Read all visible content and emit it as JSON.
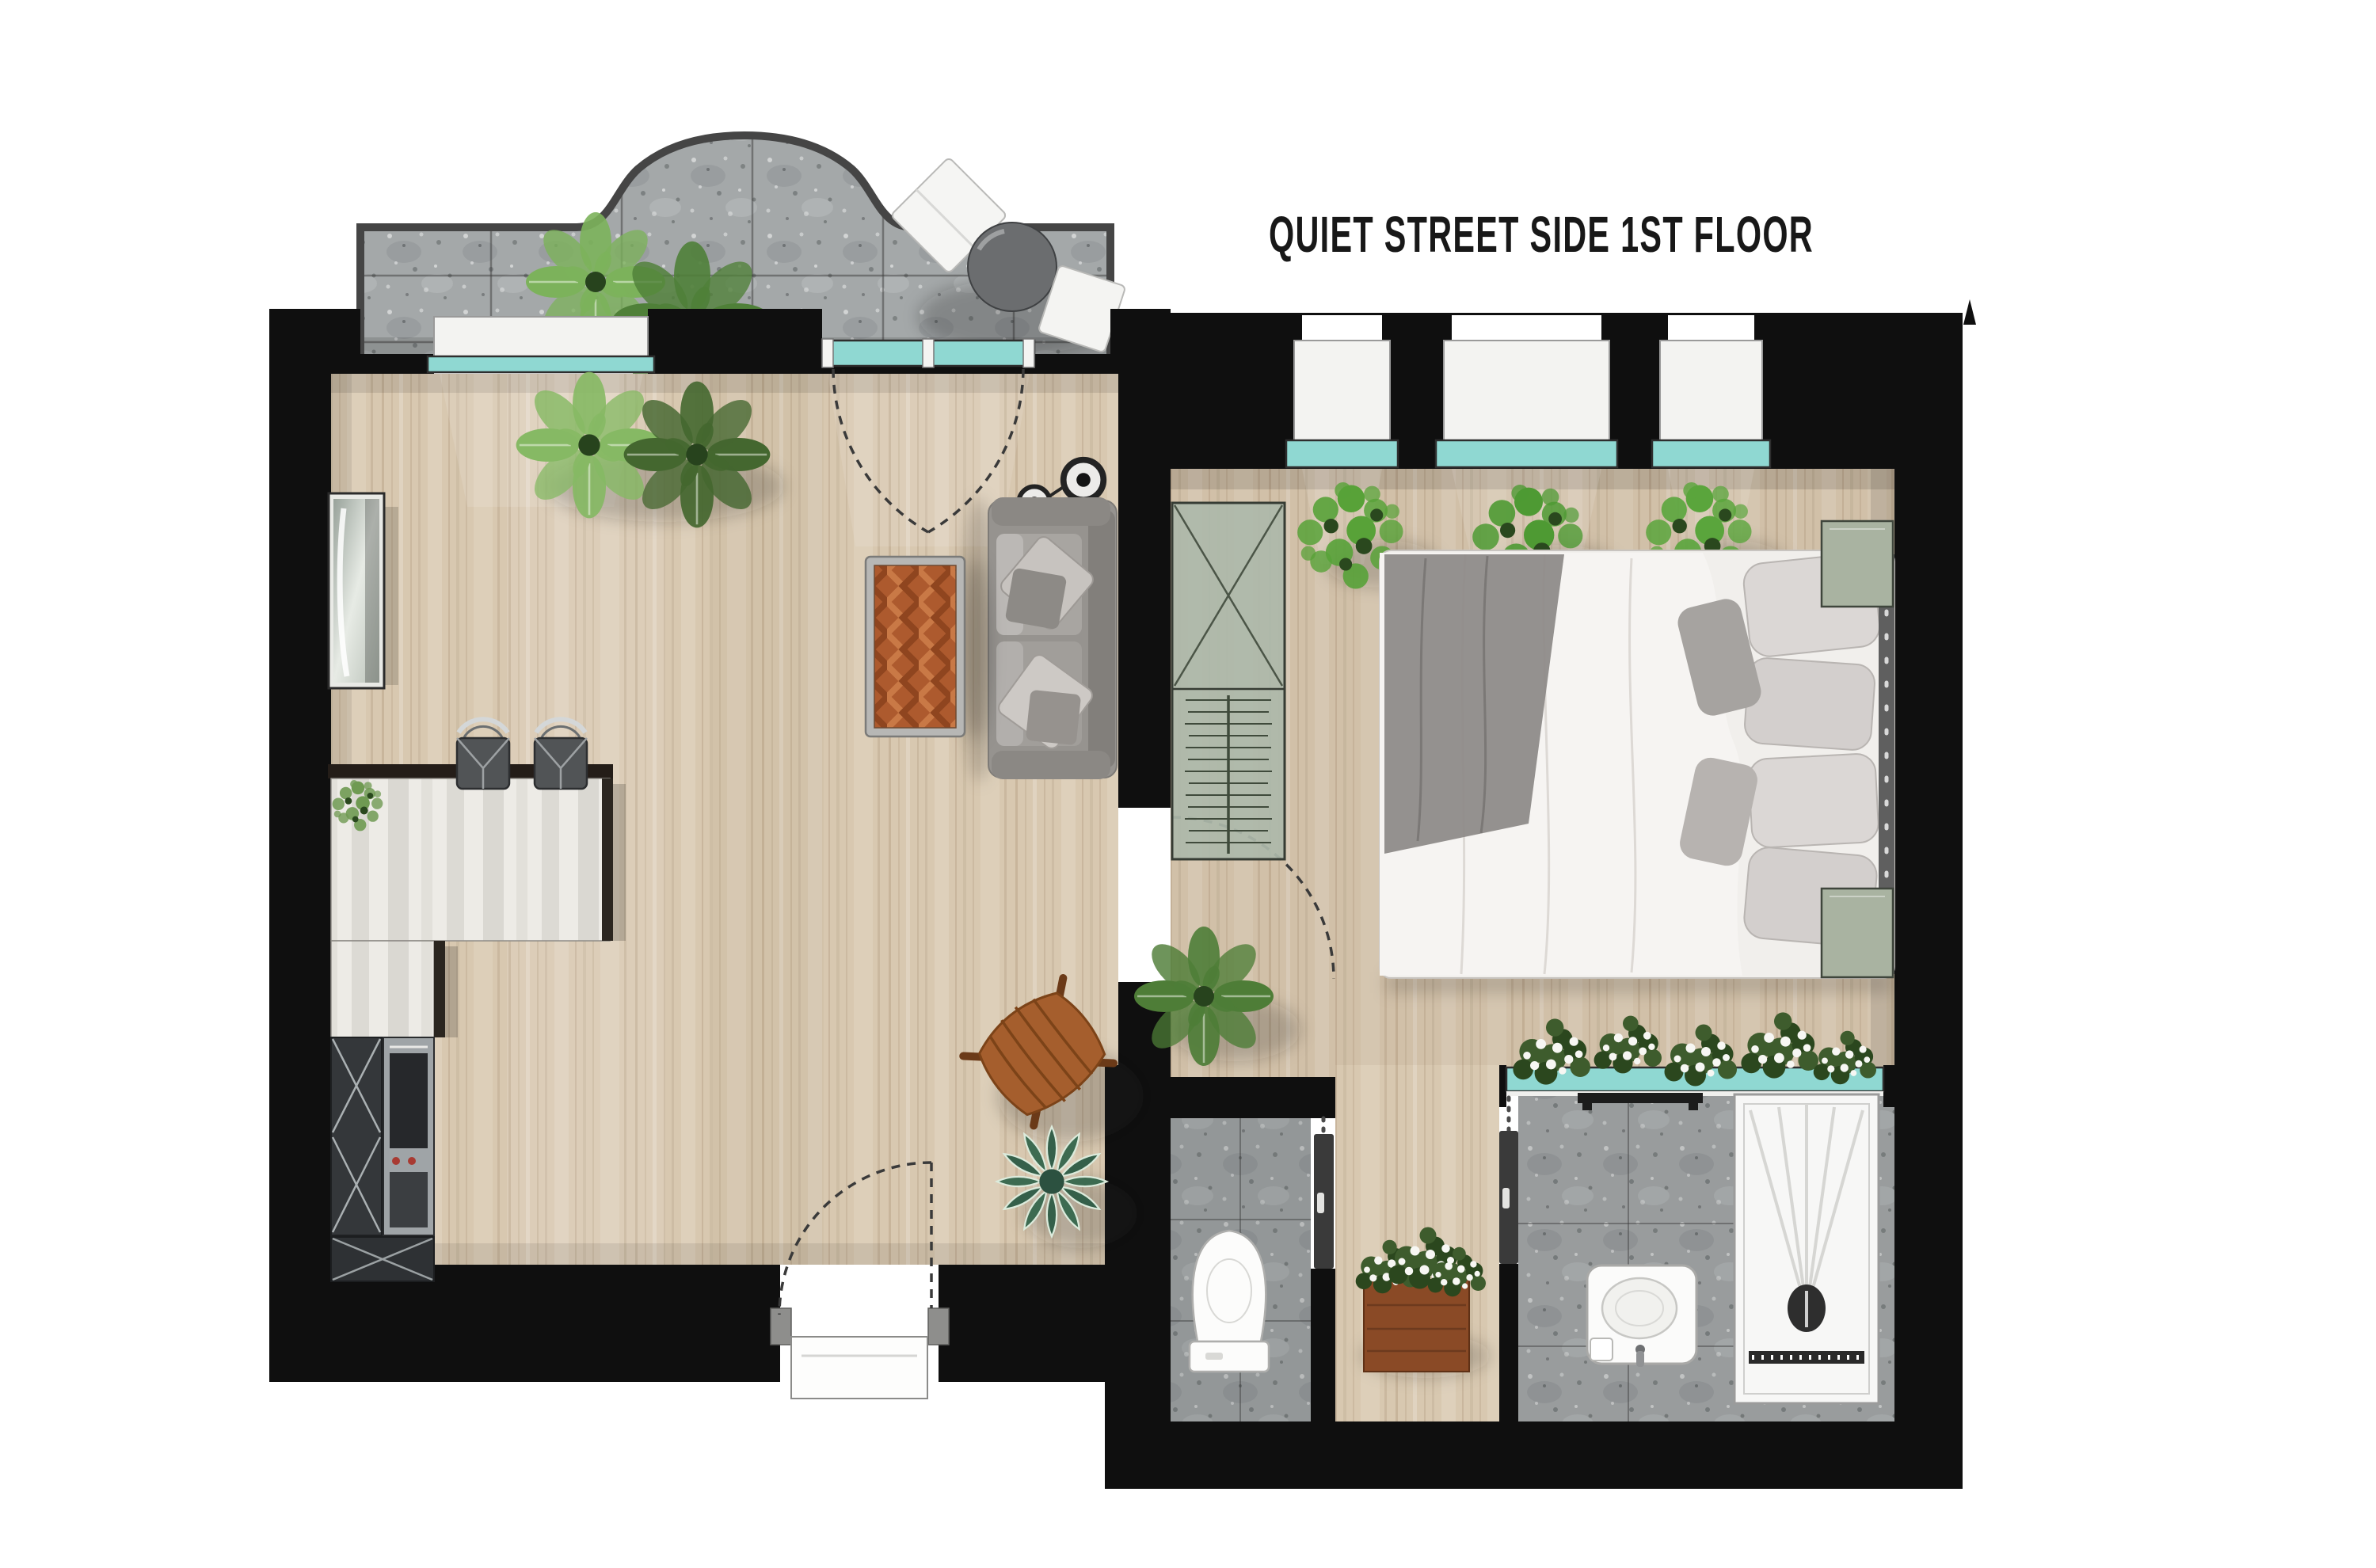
{
  "title": "QUIET STREET SIDE 1ST FLOOR",
  "colors": {
    "background": "#ffffff",
    "wall": "#0f0f0f",
    "title_text": "#181818",
    "wood_floor": "#d8c8b0",
    "stone_tile": "#a4a8a9",
    "glass": "#8fd8d2",
    "sill": "#f3f3f1",
    "counter_marble": "#edebe6",
    "sofa_gray": "#96938f",
    "coffee_table_wood": "#ad5a2e",
    "plant_green": "#5e9c46",
    "bed_linen": "#f4f2f0",
    "cabinet_sage": "#adb8aa",
    "fixture_white": "#fbfbfa",
    "planter_brown": "#8a4a26"
  },
  "areas": [
    "balcony",
    "living-kitchen",
    "bedroom",
    "hallway",
    "wc",
    "bathroom"
  ],
  "furniture_icons": {
    "balcony": [
      "monstera-plant",
      "monstera-plant",
      "lounge-chair",
      "round-table",
      "side-chair"
    ],
    "living_kitchen": [
      "monstera-plant",
      "monstera-plant",
      "tall-glass-cabinet",
      "kitchen-counter",
      "counter-plant",
      "bar-stool",
      "bar-stool",
      "appliance-column",
      "oven",
      "base-cabinet",
      "wall-lamp",
      "wall-lamp",
      "sofa",
      "coffee-table",
      "safari-chair",
      "succulent-plant"
    ],
    "bedroom": [
      "ficus-plant",
      "ficus-plant",
      "ficus-plant",
      "wardrobe",
      "double-bed",
      "nightstand",
      "nightstand",
      "monstera-plant"
    ],
    "hallway": [
      "planter-box"
    ],
    "wc": [
      "toilet"
    ],
    "bathroom": [
      "sink-vanity",
      "shower-tray",
      "towel-shelf",
      "window-flower-box"
    ]
  },
  "openings": [
    "window",
    "french-door",
    "entry-door",
    "bedroom-door",
    "pocket-door",
    "pocket-door",
    "bedroom-window",
    "bedroom-window",
    "bedroom-window",
    "interior-window"
  ],
  "icons": {
    "monstera-plant-icon": "radial-leaf-cluster",
    "ficus-plant-icon": "round-leaf-cluster",
    "succulent-plant-icon": "striped-rosette",
    "flower-box-icon": "white-blossom-cluster",
    "sofa-icon": "gray-three-seat-sofa",
    "coffee-table-icon": "herringbone-wood-table",
    "safari-chair-icon": "wooden-x-frame-chair",
    "bar-stool-icon": "square-seat-chrome-back",
    "wall-lamp-icon": "double-ring-sconce",
    "double-bed-icon": "white-duvet-bed",
    "wardrobe-icon": "glass-front-hanger-rail",
    "toilet-icon": "close-coupled-wc",
    "sink-icon": "oval-basin-vanity",
    "shower-icon": "walk-in-tray-radial-drain",
    "door-swing-icon": "dashed-quarter-arc",
    "pocket-door-icon": "sliding-leaf-bar",
    "window-icon": "teal-glass-band",
    "lounge-chair-icon": "white-folded-sling",
    "round-table-icon": "dark-round-top",
    "planter-box-icon": "wood-box-greenery",
    "north-arrow-icon": "small-black-tip"
  }
}
